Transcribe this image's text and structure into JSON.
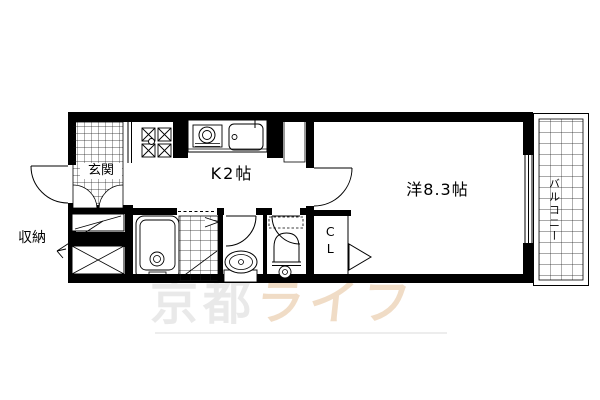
{
  "floorplan": {
    "rooms": {
      "entrance": {
        "label": "玄関"
      },
      "storage": {
        "label": "収納"
      },
      "kitchen": {
        "label": "K2帖"
      },
      "western_room": {
        "label": "洋8.3帖"
      },
      "closet": {
        "label": "CL"
      },
      "balcony": {
        "label": "バルコニー"
      }
    },
    "fixtures": [
      "front-door-swing",
      "entrance-tile-floor",
      "storage-closet",
      "meter-box",
      "washing-machine-pan",
      "kitchen-counter",
      "gas-stove",
      "kitchen-sink",
      "refrigerator-space",
      "bathtub",
      "bathroom-tile-floor",
      "bathroom-folding-door",
      "wash-basin",
      "toilet",
      "room-door-swing",
      "closet-door-triangle",
      "window",
      "balcony-tile-floor"
    ],
    "colors": {
      "walls": "#000000",
      "background": "#ffffff",
      "watermark_gray": "#e9e9e9",
      "watermark_orange": "#f0dcc6"
    },
    "watermark": {
      "part1": "京都",
      "part2": "ライフ"
    }
  }
}
